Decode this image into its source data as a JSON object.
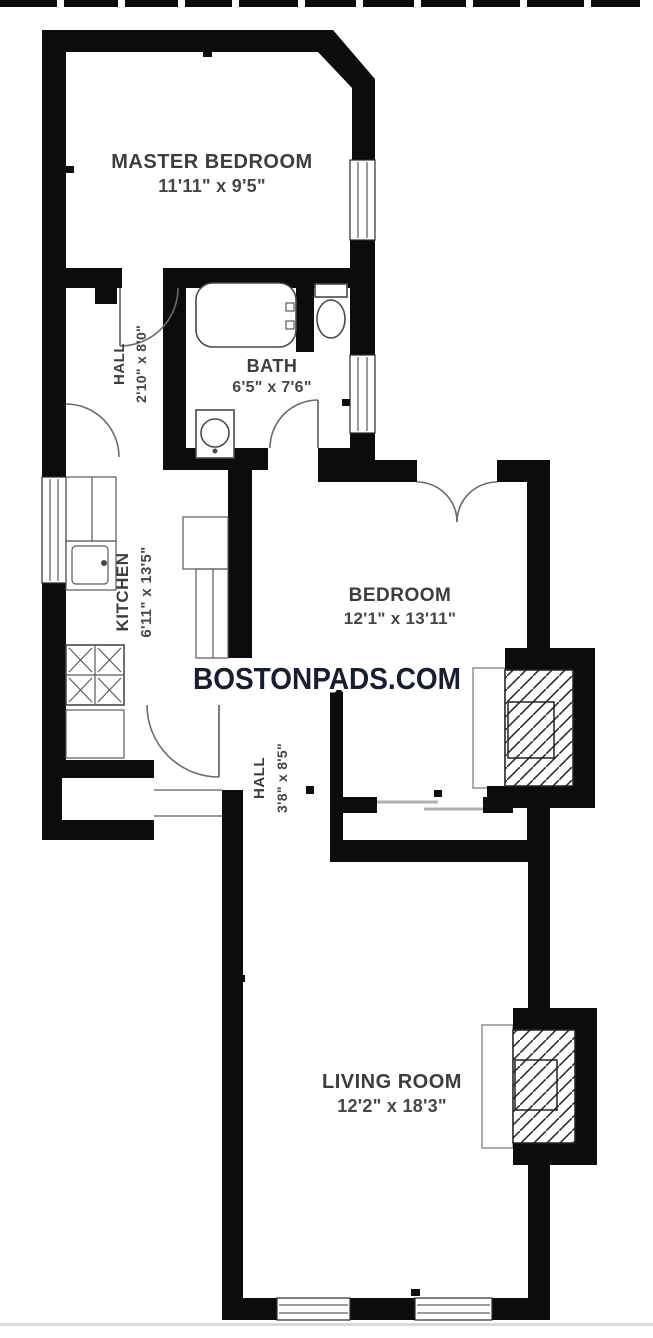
{
  "watermark": {
    "text": "BOSTONPADS.COM",
    "color": "#191d30"
  },
  "rooms": {
    "master_bedroom": {
      "name": "MASTER BEDROOM",
      "dims": "11'11\" x 9'5\""
    },
    "hall_upper": {
      "name": "HALL",
      "dims": "2'10\" x 8'0\""
    },
    "bath": {
      "name": "BATH",
      "dims": "6'5\" x 7'6\""
    },
    "kitchen": {
      "name": "KITCHEN",
      "dims": "6'11\" x 13'5\""
    },
    "bedroom": {
      "name": "BEDROOM",
      "dims": "12'1\" x 13'11\""
    },
    "hall_lower": {
      "name": "HALL",
      "dims": "3'8\" x 8'5\""
    },
    "living_room": {
      "name": "LIVING ROOM",
      "dims": "12'2\" x 18'3\""
    }
  },
  "colors": {
    "wall": "#0c0c0c",
    "label": "#3d3d3d",
    "fixture": "#4a4a4a",
    "background": "#ffffff"
  }
}
